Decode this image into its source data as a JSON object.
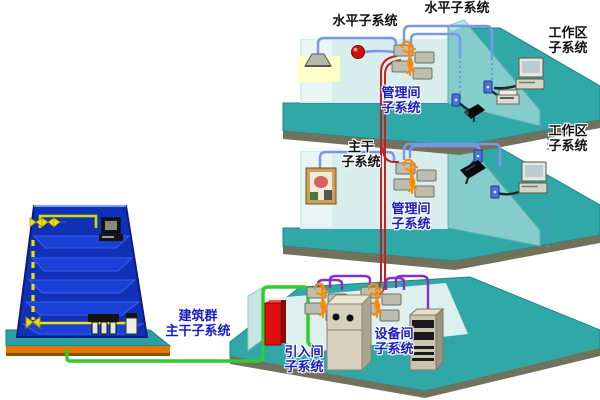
{
  "labels": {
    "horizontal_left": "水平子系统",
    "horizontal_right": "水平子系统",
    "work_area_top": {
      "l1": "工作区",
      "l2": "子系统"
    },
    "management_top": {
      "l1": "管理间",
      "l2": "子系统"
    },
    "work_area_mid": {
      "l1": "工作区",
      "l2": "子系统"
    },
    "backbone": {
      "l1": "主干",
      "l2": "子系统"
    },
    "management_mid": {
      "l1": "管理间",
      "l2": "子系统"
    },
    "campus_backbone": {
      "l1": "建筑群",
      "l2": "主干子系统"
    },
    "entrance_room": {
      "l1": "引入间",
      "l2": "子系统"
    },
    "equipment_room": {
      "l1": "设备间",
      "l2": "子系统"
    }
  },
  "colors": {
    "label_black": "#101010",
    "label_blue": "#1a1abf",
    "floor_teal": "#31a8a8",
    "floor_edge": "#72725c",
    "wall_light": "#d8eeec",
    "partition_teal": "#85cccc",
    "building_blue": "#1030b8",
    "building_slab": "#1a40d8",
    "base_orange": "#e07800",
    "cable_blue": "#7b95e8",
    "cable_red": "#c42020",
    "cable_green": "#2ecc2e",
    "cable_purple": "#8a2ec2",
    "cable_yellow": "#f0e000",
    "crossconnect_orange": "#ff8a00",
    "panel_gray": "#bdbdb0",
    "entrance_box_red": "#e01010"
  },
  "icons": {
    "building": "multi-storey-building",
    "riser": "yellow-dashed-riser-cable",
    "patch_panel": "patch-panel-cluster",
    "lamp": "ceiling-lamp",
    "alarm": "red-alarm-sphere",
    "outlet": "wall-outlet",
    "camera": "camera-device",
    "printer": "printer-device",
    "computer": "desktop-computer",
    "speaker": "wall-speaker",
    "poster": "wall-mounted-box",
    "entrance_box": "entrance-facility-box",
    "cabinet": "pbx-cabinet",
    "rack": "server-rack"
  }
}
